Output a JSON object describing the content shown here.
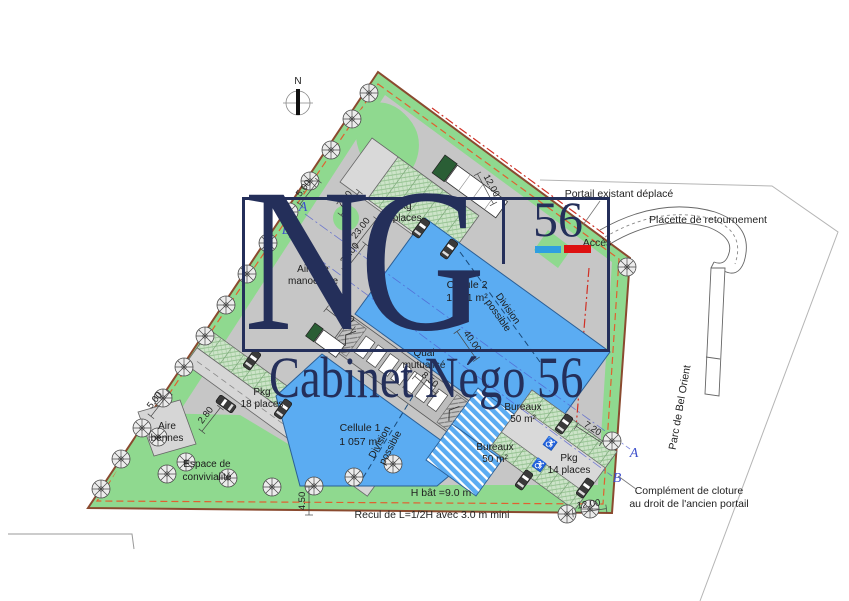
{
  "watermark": {
    "monogram": "NG",
    "number": "56",
    "company": "Cabinet Négo 56"
  },
  "compass": {
    "north": "N"
  },
  "plan": {
    "cellule2_name": "Cellule 2",
    "cellule2_area": "1 041 m²",
    "cellule1_name": "Cellule 1",
    "cellule1_area": "1 057 m²",
    "pkg6_l1": "Pkg",
    "pkg6_l2": "6 places",
    "pkg18_l1": "Pkg",
    "pkg18_l2": "18 places",
    "pkg14_l1": "Pkg",
    "pkg14_l2": "14 places",
    "bureaux1_l1": "Bureaux",
    "bureaux1_l2": "50 m²",
    "bureaux2_l1": "Bureaux",
    "bureaux2_l2": "50 m²",
    "manoeuvre_l1": "Aire de",
    "manoeuvre_l2": "manoeuvre",
    "bennes_l1": "Aire",
    "bennes_l2": "bennes",
    "convivialite_l1": "Espace de",
    "convivialite_l2": "convivialité",
    "quai_l1": "Quai",
    "quai_l2": "mutualisé",
    "division_l1": "Division",
    "division_l2": "possible",
    "hbat": "H bât =9.0 m",
    "recul": "Recul de L=1/2H avec 3.0 m mini",
    "portail": "Portail existant déplacé",
    "placette": "Placette de retournement",
    "acces": "Accès",
    "cloture_l1": "Complément de cloture",
    "cloture_l2": "au droit de l'ancien portail",
    "parc": "Parc de Bel Orient",
    "section_a": "A",
    "section_b": "B"
  },
  "dimensions": {
    "top_5": "5.00",
    "top_7": "7.00",
    "d23a": "23.00",
    "d23b": "23.00",
    "d35": "35.00",
    "road_12": "12.00",
    "d40": "40.00",
    "quai_850": "8.50",
    "west_5": "5.00",
    "west_280": "2.80",
    "south_450": "4.50",
    "east_720": "7.20",
    "se_12": "12.00"
  },
  "symbols": {
    "disabled": "♿"
  },
  "colors": {
    "navy": "#242f5a",
    "bar_blue": "#2f9fe0",
    "bar_red": "#dd1111",
    "parcel_green": "#8FD98F",
    "building_blue": "#5BACF2",
    "asphalt": "#c6c6c6",
    "platform": "#d9d9d9",
    "boundary": "#8a4a2f",
    "align_dash": "#e06030",
    "axis_red": "#d03025"
  }
}
